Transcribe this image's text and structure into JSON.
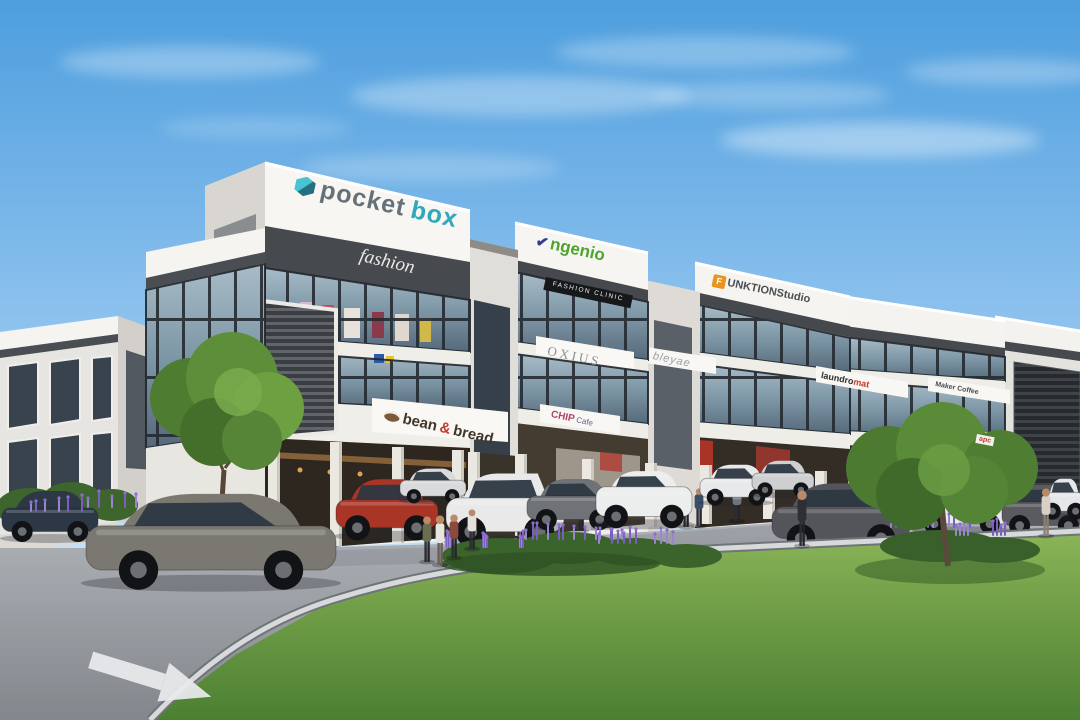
{
  "scene_title": "3-storey commercial shoplot exterior render",
  "signs": {
    "pocketbox": {
      "part1": "pocket",
      "part2": "box"
    },
    "fashion": "fashion",
    "ngenio": {
      "mark": "✔",
      "text": "ngenio"
    },
    "fashion_clinic": "FASHION CLINIC",
    "funktion": {
      "logo": "F",
      "text": "UNKTIONStudio"
    },
    "oxius": "OXIUS",
    "bleyae": "bleyae",
    "bean_bread": {
      "part1": "bean",
      "amp": "&",
      "part2": "bread"
    },
    "chip_cafe": {
      "name": "CHIP",
      "suffix": "Cafe"
    },
    "laundromat": {
      "part1": "laundro",
      "part2": "mat"
    },
    "maker_coffee": "Maker Coffee",
    "apc": "apc"
  },
  "colors": {
    "sky_top": "#4d9ede",
    "facade_white": "#f3f1ed",
    "teal": "#2fa8bc",
    "green": "#4ea52d",
    "orange": "#e8941f",
    "red_accent": "#c0392b",
    "lawn": "#5d8f3e",
    "flower_purple": "#7b5fc0"
  },
  "props": {
    "cars": [
      {
        "x": 2,
        "y": 490,
        "w": 96,
        "h": 50,
        "c": "#2d3846",
        "t": "sedan"
      },
      {
        "x": 336,
        "y": 478,
        "w": 102,
        "h": 60,
        "c": "#a93527",
        "t": "sedan"
      },
      {
        "x": 400,
        "y": 468,
        "w": 66,
        "h": 34,
        "c": "#d9dadb",
        "t": "sedan"
      },
      {
        "x": 446,
        "y": 472,
        "w": 118,
        "h": 72,
        "c": "#e9e9ea",
        "t": "hatch"
      },
      {
        "x": 527,
        "y": 478,
        "w": 92,
        "h": 50,
        "c": "#6f7276",
        "t": "sedan"
      },
      {
        "x": 596,
        "y": 470,
        "w": 96,
        "h": 56,
        "c": "#eceded",
        "t": "suv"
      },
      {
        "x": 700,
        "y": 464,
        "w": 72,
        "h": 40,
        "c": "#e8e9ea",
        "t": "sedan"
      },
      {
        "x": 752,
        "y": 460,
        "w": 62,
        "h": 36,
        "c": "#cdcfd1",
        "t": "sedan"
      },
      {
        "x": 772,
        "y": 482,
        "w": 138,
        "h": 68,
        "c": "#53555a",
        "t": "sedan"
      },
      {
        "x": 914,
        "y": 484,
        "w": 96,
        "h": 48,
        "c": "#e9eaeb",
        "t": "sedan"
      },
      {
        "x": 1002,
        "y": 484,
        "w": 84,
        "h": 50,
        "c": "#595b5f",
        "t": "sedan"
      },
      {
        "x": 1044,
        "y": 478,
        "w": 40,
        "h": 40,
        "c": "#e6e7e8",
        "t": "sedan"
      },
      {
        "x": 86,
        "y": 492,
        "w": 250,
        "h": 94,
        "c": "#7b7871",
        "t": "sedan"
      }
    ],
    "people_back": [
      {
        "x": 520,
        "y": 540,
        "h": 38,
        "top": "#b9b4ac"
      },
      {
        "x": 547,
        "y": 536,
        "h": 42,
        "top": "#d8d4cc"
      },
      {
        "x": 581,
        "y": 531,
        "h": 36,
        "top": "#7b8a96"
      },
      {
        "x": 686,
        "y": 527,
        "h": 40,
        "top": "#4e6b4a"
      },
      {
        "x": 699,
        "y": 526,
        "h": 38,
        "top": "#3e4e66"
      },
      {
        "x": 737,
        "y": 521,
        "h": 36,
        "top": "#8e97a0"
      },
      {
        "x": 870,
        "y": 520,
        "h": 40,
        "top": "#bf5f35"
      },
      {
        "x": 615,
        "y": 516,
        "h": 30,
        "top": "#cfd3d6"
      }
    ],
    "people_front": [
      {
        "x": 427,
        "y": 562,
        "h": 46,
        "top": "#6b6d52"
      },
      {
        "x": 440,
        "y": 565,
        "h": 50,
        "top": "#e8e4de",
        "pants": "#6a5f55"
      },
      {
        "x": 454,
        "y": 558,
        "h": 44,
        "top": "#8a4a3e"
      },
      {
        "x": 472,
        "y": 549,
        "h": 40,
        "top": "#e5e2dc"
      },
      {
        "x": 802,
        "y": 546,
        "h": 56,
        "top": "#2e2e34"
      },
      {
        "x": 1046,
        "y": 536,
        "h": 48,
        "top": "#d9cfc4",
        "pants": "#8a8076"
      }
    ],
    "flowers": [
      {
        "x": 500,
        "y": 548,
        "s": 110,
        "n": 14
      },
      {
        "x": 575,
        "y": 540,
        "s": 100,
        "n": 12
      },
      {
        "x": 638,
        "y": 544,
        "s": 80,
        "n": 10
      },
      {
        "x": 935,
        "y": 528,
        "s": 90,
        "n": 11
      },
      {
        "x": 990,
        "y": 536,
        "s": 70,
        "n": 8
      },
      {
        "x": 60,
        "y": 512,
        "s": 60,
        "n": 6
      },
      {
        "x": 112,
        "y": 508,
        "s": 50,
        "n": 5
      }
    ],
    "columns": [
      [
        268,
        438,
        110
      ],
      [
        330,
        442,
        104
      ],
      [
        392,
        447,
        96
      ],
      [
        452,
        450,
        88
      ],
      [
        468,
        452,
        86
      ],
      [
        515,
        454,
        82
      ],
      [
        582,
        459,
        71
      ],
      [
        645,
        463,
        64
      ],
      [
        700,
        465,
        59
      ],
      [
        763,
        469,
        50
      ],
      [
        815,
        471,
        45
      ],
      [
        848,
        472,
        43
      ],
      [
        908,
        475,
        36
      ],
      [
        962,
        477,
        31
      ],
      [
        1008,
        479,
        27
      ],
      [
        1062,
        481,
        22
      ]
    ]
  }
}
